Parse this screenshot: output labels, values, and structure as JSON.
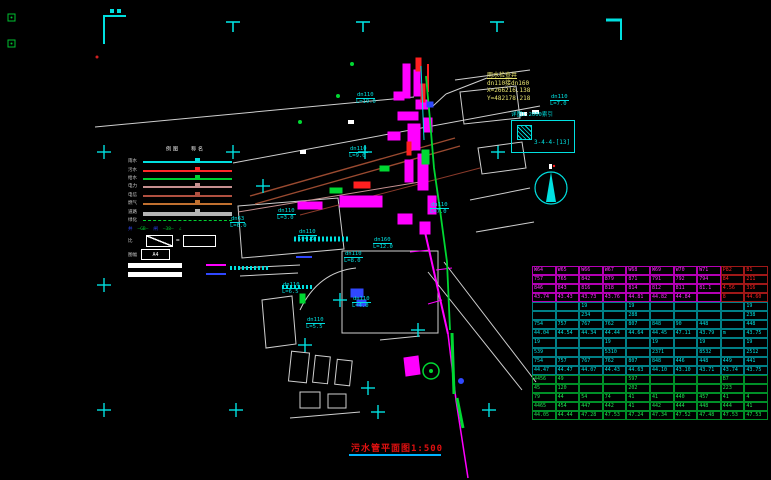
{
  "colors": {
    "cyan": "#00e0e0",
    "magenta": "#ff00ff",
    "red": "#ff2020",
    "green": "#00d832",
    "white": "#d8d8d8",
    "blue": "#3048ff",
    "brown": "#9a4a30",
    "rosy": "#c59090",
    "gray": "#a8a8a8"
  },
  "title": {
    "text": "污水管平面图1:500"
  },
  "well_callout": {
    "title": "雨水检查井",
    "pipe": "dn110接dn160",
    "x": "X=266216.138",
    "y": "Y=482178.218"
  },
  "index_box": {
    "label": "详图1:2000索引",
    "code": "3-4-4-[13]"
  },
  "legend": {
    "headers": [
      "图例",
      "名称"
    ],
    "rows": [
      {
        "label": "雨水",
        "color": "#00e0e0",
        "h": 2
      },
      {
        "label": "污水",
        "color": "#ff2828",
        "h": 2
      },
      {
        "label": "给水",
        "color": "#00d030",
        "h": 2
      },
      {
        "label": "电力",
        "color": "#c59090",
        "h": 2
      },
      {
        "label": "电信",
        "color": "#b05040",
        "h": 2
      },
      {
        "label": "燃气",
        "color": "#c07030",
        "h": 2
      },
      {
        "label": "道路",
        "color": "#b5b5b5",
        "h": 4
      },
      {
        "label": "绿化",
        "color": "#00d030",
        "h": 2,
        "dotted": true
      }
    ],
    "extra_tokens": [
      {
        "t": "井",
        "c": "#3048ff"
      },
      {
        "t": "—GB—",
        "c": "#00d030"
      },
      {
        "t": "闸",
        "c": "#3048ff"
      },
      {
        "t": "—38—",
        "c": "#00d030"
      },
      {
        "t": "∠",
        "c": "#00d030"
      }
    ],
    "ratio_label": "比",
    "eq": "=",
    "a4_label": "图幅",
    "a4_value": "A4"
  },
  "plan_labels": [
    {
      "t": "dn110",
      "s": "L=19.0",
      "x": 356,
      "y": 92
    },
    {
      "t": "dn110",
      "s": "L=9.0",
      "x": 349,
      "y": 146
    },
    {
      "t": "dn110",
      "s": "L=7.0",
      "x": 430,
      "y": 202
    },
    {
      "t": "dn110",
      "s": "L=7.0",
      "x": 550,
      "y": 94
    },
    {
      "t": "dn110",
      "s": "L=3.0",
      "x": 277,
      "y": 208
    },
    {
      "t": "dn63",
      "s": "L=6.0",
      "x": 230,
      "y": 216
    },
    {
      "t": "dn110",
      "s": "L=4.5",
      "x": 298,
      "y": 229
    },
    {
      "t": "dn110",
      "s": "L=8.0",
      "x": 344,
      "y": 251
    },
    {
      "t": "dn160",
      "s": "L=12.0",
      "x": 373,
      "y": 237
    },
    {
      "t": "dn110",
      "s": "L=6.5",
      "x": 282,
      "y": 282
    },
    {
      "t": "dn110",
      "s": "L=5.5",
      "x": 306,
      "y": 317
    },
    {
      "t": "dn110",
      "s": "L=4.0",
      "x": 352,
      "y": 296
    }
  ],
  "table": {
    "sections": [
      {
        "text": "#ff30ff",
        "border": "#b400b4",
        "red_cols": [
          8,
          9
        ],
        "rows": [
          [
            "W64",
            "W65",
            "W66",
            "W67",
            "W68",
            "W69",
            "W70",
            "W71",
            "P82",
            "B1"
          ],
          [
            "757",
            "765",
            "842",
            "879",
            "871",
            "791",
            "792",
            "794",
            "84",
            "211"
          ],
          [
            "846",
            "843",
            "816",
            "818",
            "814",
            "812",
            "811",
            "81.1",
            "4.56",
            "316"
          ],
          [
            "43.74",
            "43.43",
            "43.73",
            "43.76",
            "44.81",
            "44.82",
            "44.84",
            "",
            "8",
            "44.60"
          ]
        ]
      },
      {
        "text": "#00e0e0",
        "border": "#007f86",
        "rows": [
          [
            "",
            "",
            "19",
            "",
            "19",
            "",
            "",
            "",
            "",
            "19"
          ],
          [
            "",
            "",
            "234",
            "",
            "288",
            "",
            "",
            "",
            "",
            "238"
          ],
          [
            "754",
            "757",
            "767",
            "762",
            "807",
            "848",
            "90",
            "448",
            "",
            "448"
          ],
          [
            "44.04",
            "44.54",
            "44.34",
            "44.44",
            "44.64",
            "44.45",
            "47.11",
            "43.79",
            "m",
            "43.75"
          ]
        ]
      },
      {
        "text": "#00e0e0",
        "border": "#007f86",
        "rows": [
          [
            "19",
            "",
            "",
            "19",
            "",
            "19",
            "",
            "19",
            "",
            "19"
          ],
          [
            "539",
            "",
            "",
            "5310",
            "",
            "2371",
            "",
            "8532",
            "",
            "2512"
          ],
          [
            "754",
            "757",
            "767",
            "762",
            "807",
            "848",
            "446",
            "448",
            "449",
            "441"
          ],
          [
            "44.47",
            "44.47",
            "44.07",
            "44.43",
            "44.63",
            "44.10",
            "43.10",
            "43.71",
            "43.74",
            "43.75"
          ]
        ]
      },
      {
        "text": "#20e050",
        "border": "#008f28",
        "rows": [
          [
            "4456",
            "49",
            "",
            "",
            "597",
            "",
            "",
            "",
            "B7",
            ""
          ],
          [
            "45",
            "120",
            "",
            "",
            "202",
            "",
            "",
            "",
            "223",
            ""
          ],
          [
            "79",
            "44",
            "54",
            "74",
            "41",
            "41",
            "440",
            "457",
            "41",
            "4"
          ],
          [
            "4465",
            "454",
            "447",
            "442",
            "41",
            "442",
            "444",
            "448",
            "444",
            "41"
          ],
          [
            "44.05",
            "44.44",
            "47.28",
            "47.53",
            "47.24",
            "47.34",
            "47.52",
            "47.48",
            "47.53",
            "47.53"
          ]
        ]
      }
    ]
  }
}
